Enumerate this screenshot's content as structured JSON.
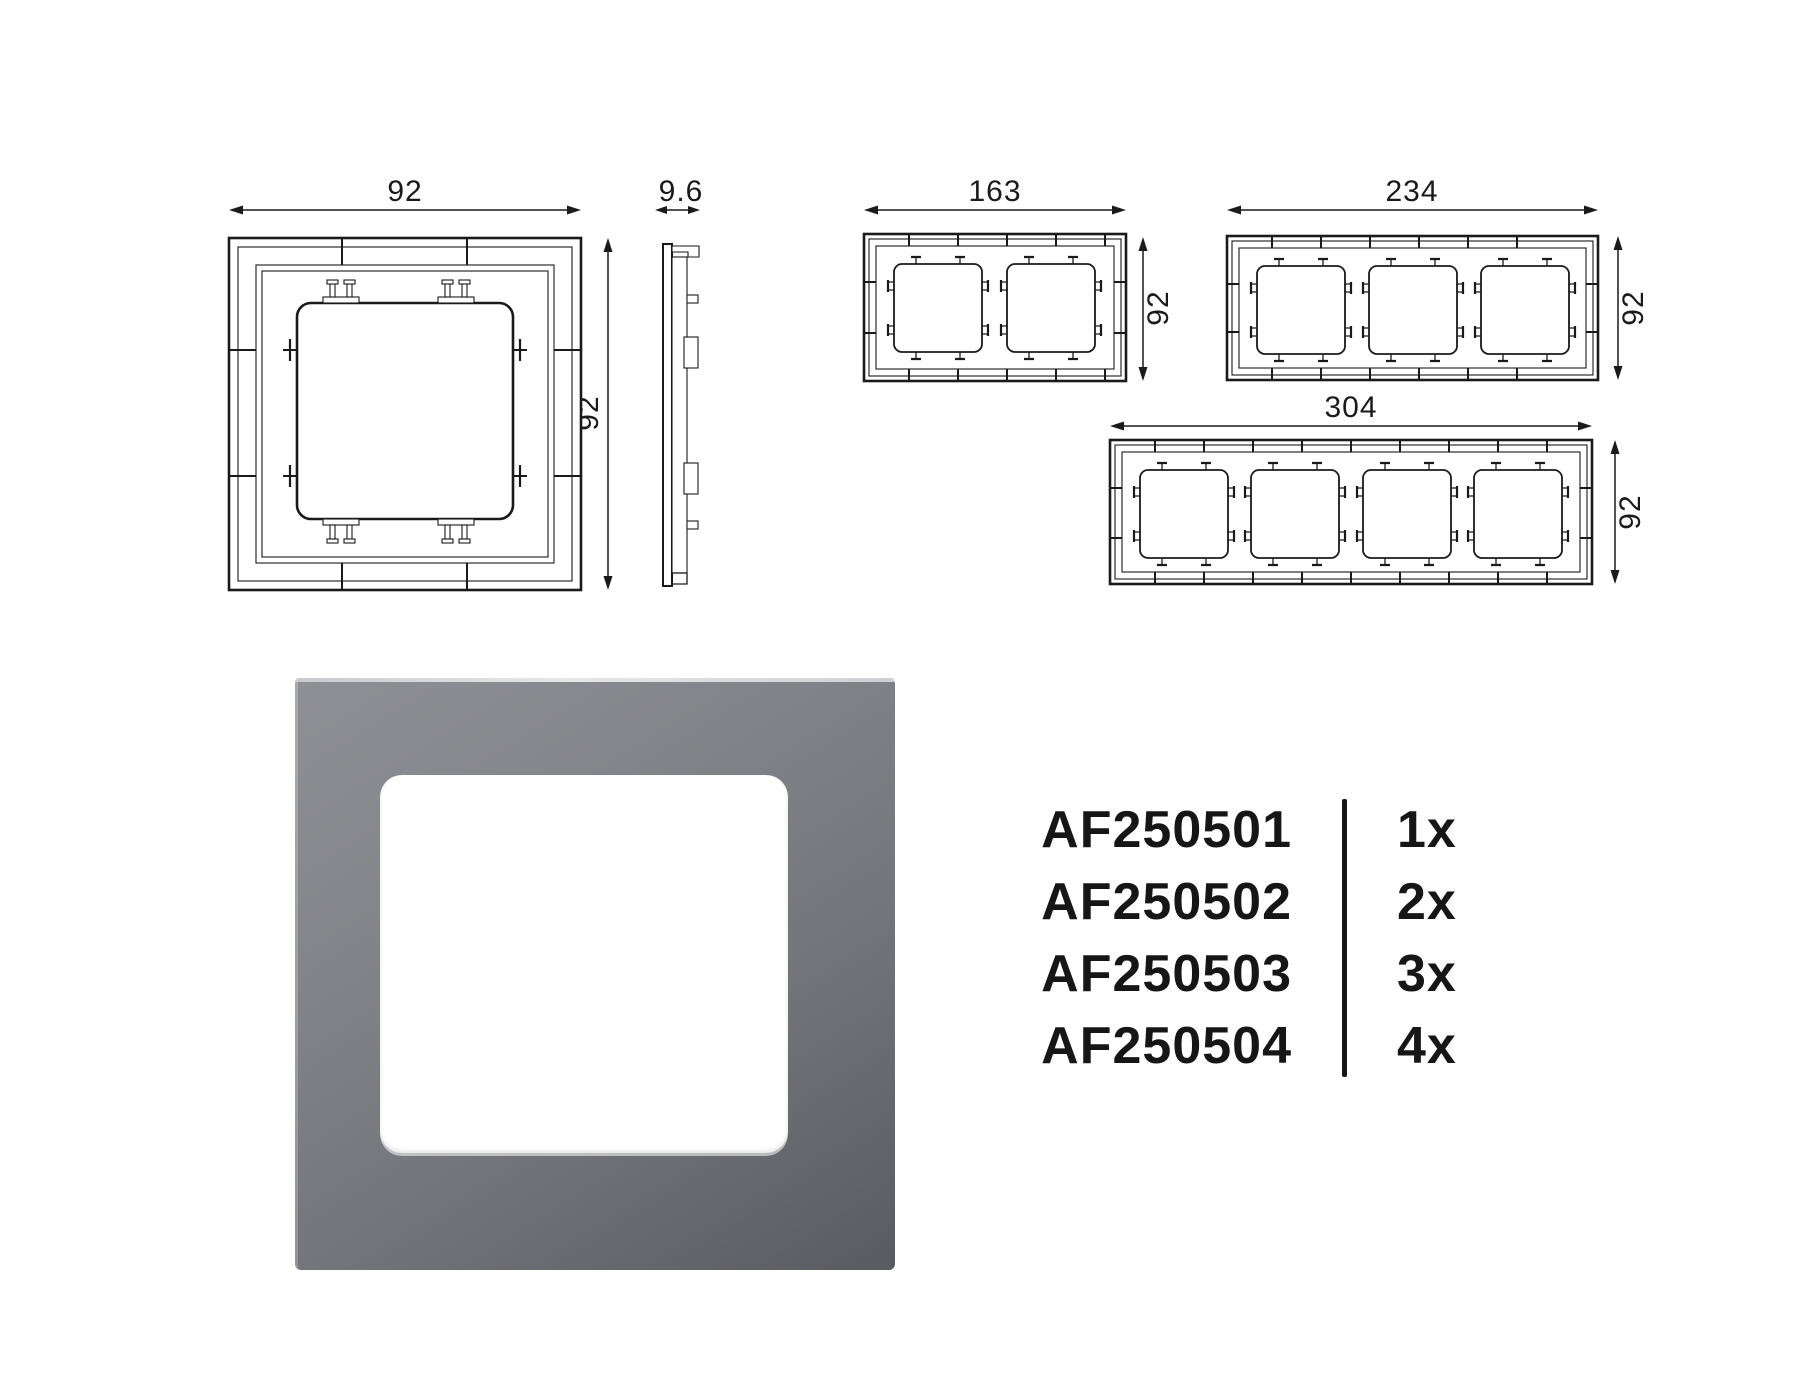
{
  "drawings": {
    "front_1gang": {
      "width_mm": "92",
      "height_mm": "92"
    },
    "side_view": {
      "depth_mm": "9.6"
    },
    "front_2gang": {
      "width_mm": "163",
      "height_mm": "92"
    },
    "front_3gang": {
      "width_mm": "234",
      "height_mm": "92"
    },
    "front_4gang": {
      "width_mm": "304",
      "height_mm": "92"
    }
  },
  "product_list": {
    "rows": [
      {
        "code": "AF250501",
        "qty": "1x"
      },
      {
        "code": "AF250502",
        "qty": "2x"
      },
      {
        "code": "AF250503",
        "qty": "3x"
      },
      {
        "code": "AF250504",
        "qty": "4x"
      }
    ]
  },
  "colors": {
    "frame_gray_light": "#8f9095",
    "frame_gray_dark": "#5a5b60",
    "line": "#1a1a1a",
    "background": "#ffffff"
  }
}
